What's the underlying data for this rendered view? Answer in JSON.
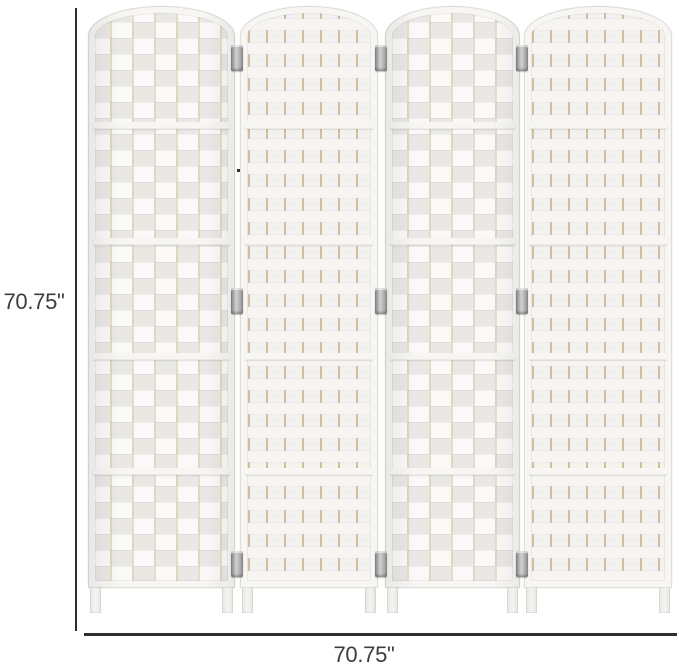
{
  "diagram": {
    "title": "4-panel folding room divider dimension diagram",
    "height_label": "70.75\"",
    "width_label": "70.75\"",
    "panel_width_label": "17.75\"",
    "panel_count": 4,
    "hinge_count": 9
  },
  "colors": {
    "dimension-line": "#2e2e2e",
    "dimension-text": "#3d3d3d",
    "panel-base": "#f4f2ef",
    "frame": "#f7f6f3",
    "weave-accent": "#d8c6a0",
    "hinge": "#9b9b9b",
    "background": "#ffffff"
  }
}
